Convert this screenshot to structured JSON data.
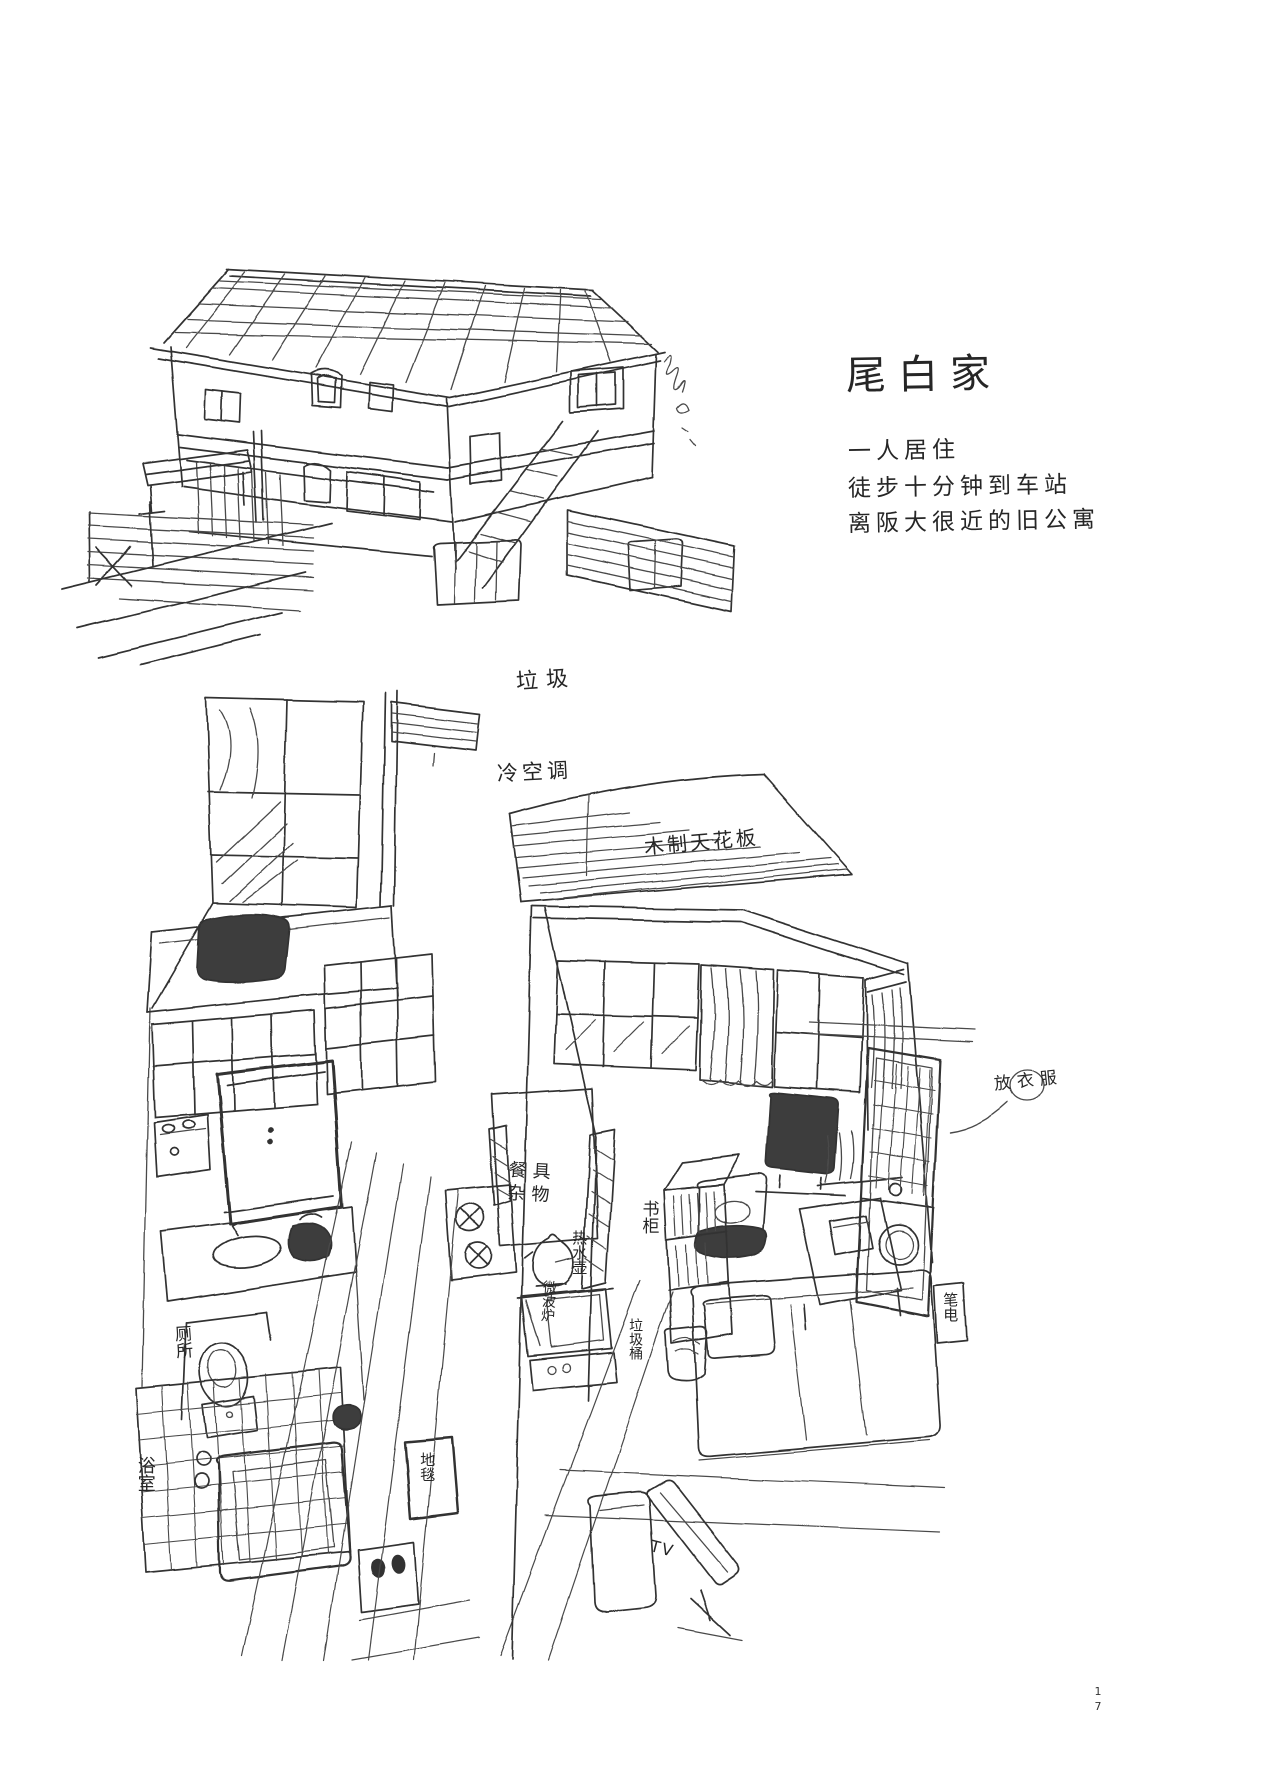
{
  "page": {
    "digits": [
      "1",
      "7"
    ]
  },
  "colors": {
    "ink": "#333333",
    "ink_light": "#5b5b5b",
    "ink_fill": "#3d3d3d",
    "paper": "#ffffff"
  },
  "header": {
    "title": "尾白家",
    "notes": [
      "一人居住",
      "徒步十分钟到车站",
      "离阪大很近的旧公寓"
    ]
  },
  "exterior": {
    "label_garbage": "垃圾"
  },
  "interior": {
    "label_ac": "冷空调",
    "label_ceiling": "木制天花板",
    "label_dishes_line1": "餐具",
    "label_dishes_line2": "杂物",
    "label_kettle": "热水壶",
    "label_microwave": "微波炉",
    "label_bookshelf": "书柜",
    "label_trash_bin": "垃圾桶",
    "label_toilet": "厕所",
    "label_bathroom": "浴室",
    "label_carpet": "地毯",
    "label_tv": "TV",
    "label_clothes": "放衣服",
    "label_laptop": "笔电"
  }
}
